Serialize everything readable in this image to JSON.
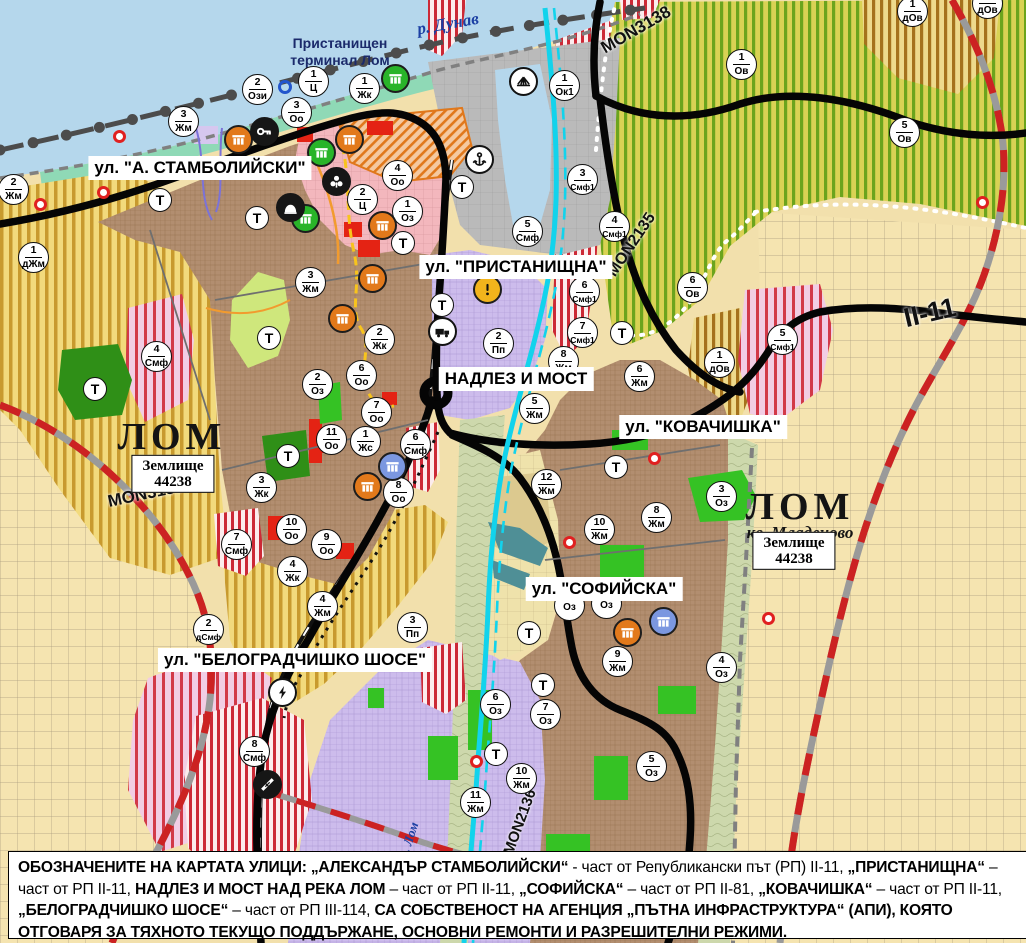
{
  "palette": {
    "water": "#b5d7ec",
    "coast_mint": "#8fd9b6",
    "farmland": "#f2da7c",
    "farmland_stripe": "#c89a2e",
    "vineyard": "#d9d254",
    "vineyard_stripe": "#6ba41d",
    "town_brown": "#b28e70",
    "production_purple": "#cdbcec",
    "mixed_red_stripe": "#cc2936",
    "center_pink": "#f3b7bd",
    "port_gray": "#bababa",
    "floodplain": "#cdd8ac",
    "fields_cream": "#f5e4b0",
    "park_green": "#35c224",
    "road_black": "#050505",
    "project_road_red": "#cc2222",
    "river_cyan": "#12d3ec",
    "marker_orange": "#e2791b",
    "marker_green": "#29b429",
    "marker_blue": "#7b97e0"
  },
  "labels": {
    "streets": [
      {
        "text": "ул. \"А. СТАМБОЛИЙСКИ\"",
        "x": 200,
        "y": 168
      },
      {
        "text": "ул. \"ПРИСТАНИЩНА\"",
        "x": 516,
        "y": 267
      },
      {
        "text": "НАДЛЕЗ И МОСТ",
        "x": 516,
        "y": 379
      },
      {
        "text": "ул. \"КОВАЧИШКА\"",
        "x": 703,
        "y": 427
      },
      {
        "text": "ул. \"СОФИЙСКА\"",
        "x": 604,
        "y": 589
      },
      {
        "text": "ул. \"БЕЛОГРАДЧИШКО ШОСЕ\"",
        "x": 295,
        "y": 660
      }
    ],
    "cities": [
      {
        "name": "ЛОМ",
        "x": 172,
        "y": 437,
        "size": 38,
        "sub": "",
        "subx": 0,
        "suby": 0
      },
      {
        "name": "ЛОМ",
        "x": 800,
        "y": 507,
        "size": 38,
        "sub": "кв. Младеново",
        "subx": 800,
        "suby": 533
      }
    ],
    "landholdings": [
      {
        "line1": "Землище",
        "line2": "44238",
        "x": 173,
        "y": 474
      },
      {
        "line1": "Землище",
        "line2": "44238",
        "x": 794,
        "y": 551
      }
    ],
    "road_codes": [
      {
        "text": "MON3139",
        "x": 146,
        "y": 494,
        "rot": -12,
        "size": 17
      },
      {
        "text": "MON3138",
        "x": 636,
        "y": 30,
        "rot": -30,
        "size": 17
      },
      {
        "text": "MON2135",
        "x": 632,
        "y": 245,
        "rot": -56,
        "size": 16
      },
      {
        "text": "MON2136",
        "x": 520,
        "y": 822,
        "rot": -70,
        "size": 15
      },
      {
        "text": "II-11",
        "x": 930,
        "y": 313,
        "rot": -13,
        "size": 27
      }
    ],
    "rivers": [
      {
        "text": "р. Дунав",
        "x": 448,
        "y": 24,
        "rot": -10,
        "size": 17
      },
      {
        "text": "р. Лом",
        "x": 409,
        "y": 840,
        "rot": -72,
        "size": 13
      }
    ],
    "terminal": {
      "line1": "Пристанищен",
      "line2": "терминал Лом",
      "x": 340,
      "y": 52
    }
  },
  "markers": {
    "transport_letter": "Т",
    "zones": [
      {
        "x": 14,
        "y": 190,
        "n": "2",
        "c": "Жм"
      },
      {
        "x": 34,
        "y": 258,
        "n": "1",
        "c": "дЖм"
      },
      {
        "x": 184,
        "y": 122,
        "n": "3",
        "c": "Жм"
      },
      {
        "x": 258,
        "y": 90,
        "n": "2",
        "c": "Ози"
      },
      {
        "x": 314,
        "y": 82,
        "n": "1",
        "c": "Ц"
      },
      {
        "x": 297,
        "y": 113,
        "n": "3",
        "c": "Оо"
      },
      {
        "x": 365,
        "y": 89,
        "n": "1",
        "c": "Жк"
      },
      {
        "x": 398,
        "y": 176,
        "n": "4",
        "c": "Оо"
      },
      {
        "x": 363,
        "y": 200,
        "n": "2",
        "c": "Ц"
      },
      {
        "x": 408,
        "y": 212,
        "n": "1",
        "c": "Оз"
      },
      {
        "x": 157,
        "y": 357,
        "n": "4",
        "c": "Смф"
      },
      {
        "x": 311,
        "y": 283,
        "n": "3",
        "c": "Жм"
      },
      {
        "x": 380,
        "y": 340,
        "n": "2",
        "c": "Жк"
      },
      {
        "x": 318,
        "y": 385,
        "n": "2",
        "c": "Оз"
      },
      {
        "x": 362,
        "y": 376,
        "n": "6",
        "c": "Оо"
      },
      {
        "x": 377,
        "y": 413,
        "n": "7",
        "c": "Оо"
      },
      {
        "x": 332,
        "y": 440,
        "n": "11",
        "c": "Оо"
      },
      {
        "x": 366,
        "y": 442,
        "n": "1",
        "c": "Жс"
      },
      {
        "x": 416,
        "y": 445,
        "n": "6",
        "c": "Смф"
      },
      {
        "x": 399,
        "y": 493,
        "n": "8",
        "c": "Оо"
      },
      {
        "x": 262,
        "y": 488,
        "n": "3",
        "c": "Жк"
      },
      {
        "x": 292,
        "y": 530,
        "n": "10",
        "c": "Оо"
      },
      {
        "x": 327,
        "y": 545,
        "n": "9",
        "c": "Оо"
      },
      {
        "x": 293,
        "y": 572,
        "n": "4",
        "c": "Жк"
      },
      {
        "x": 237,
        "y": 545,
        "n": "7",
        "c": "Смф"
      },
      {
        "x": 528,
        "y": 232,
        "n": "5",
        "c": "Смф"
      },
      {
        "x": 565,
        "y": 86,
        "n": "1",
        "c": "Ок1"
      },
      {
        "x": 583,
        "y": 180,
        "n": "3",
        "c": "Смф1"
      },
      {
        "x": 615,
        "y": 227,
        "n": "4",
        "c": "Смф1"
      },
      {
        "x": 585,
        "y": 292,
        "n": "6",
        "c": "Смф1"
      },
      {
        "x": 583,
        "y": 333,
        "n": "7",
        "c": "Смф1"
      },
      {
        "x": 499,
        "y": 344,
        "n": "2",
        "c": "Пп"
      },
      {
        "x": 564,
        "y": 362,
        "n": "8",
        "c": "Жм"
      },
      {
        "x": 535,
        "y": 409,
        "n": "5",
        "c": "Жм"
      },
      {
        "x": 742,
        "y": 65,
        "n": "1",
        "c": "Ов"
      },
      {
        "x": 913,
        "y": 12,
        "n": "1",
        "c": "дОв"
      },
      {
        "x": 988,
        "y": 4,
        "n": "1",
        "c": "дОв"
      },
      {
        "x": 905,
        "y": 133,
        "n": "5",
        "c": "Ов"
      },
      {
        "x": 693,
        "y": 288,
        "n": "6",
        "c": "Ов"
      },
      {
        "x": 783,
        "y": 340,
        "n": "5",
        "c": "Смф1"
      },
      {
        "x": 720,
        "y": 363,
        "n": "1",
        "c": "дОв"
      },
      {
        "x": 640,
        "y": 377,
        "n": "6",
        "c": "Жм"
      },
      {
        "x": 657,
        "y": 518,
        "n": "8",
        "c": "Жм"
      },
      {
        "x": 547,
        "y": 485,
        "n": "12",
        "c": "Жм"
      },
      {
        "x": 600,
        "y": 530,
        "n": "10",
        "c": "Жм"
      },
      {
        "x": 618,
        "y": 662,
        "n": "9",
        "c": "Жм"
      },
      {
        "x": 722,
        "y": 497,
        "n": "3",
        "c": "Оз"
      },
      {
        "x": 570,
        "y": 606,
        "n": "",
        "c": "Оз"
      },
      {
        "x": 607,
        "y": 604,
        "n": "",
        "c": "Оз"
      },
      {
        "x": 722,
        "y": 668,
        "n": "4",
        "c": "Оз"
      },
      {
        "x": 652,
        "y": 767,
        "n": "5",
        "c": "Оз"
      },
      {
        "x": 496,
        "y": 705,
        "n": "6",
        "c": "Оз"
      },
      {
        "x": 546,
        "y": 715,
        "n": "7",
        "c": "Оз"
      },
      {
        "x": 522,
        "y": 779,
        "n": "10",
        "c": "Жм"
      },
      {
        "x": 476,
        "y": 803,
        "n": "11",
        "c": "Жм"
      },
      {
        "x": 209,
        "y": 630,
        "n": "2",
        "c": "дСмф"
      },
      {
        "x": 323,
        "y": 607,
        "n": "4",
        "c": "Жм"
      },
      {
        "x": 413,
        "y": 628,
        "n": "3",
        "c": "Пп"
      },
      {
        "x": 255,
        "y": 752,
        "n": "8",
        "c": "Смф"
      }
    ],
    "transport": [
      {
        "x": 160,
        "y": 200
      },
      {
        "x": 257,
        "y": 218
      },
      {
        "x": 269,
        "y": 338
      },
      {
        "x": 288,
        "y": 456
      },
      {
        "x": 95,
        "y": 389
      },
      {
        "x": 462,
        "y": 187
      },
      {
        "x": 403,
        "y": 243
      },
      {
        "x": 442,
        "y": 305
      },
      {
        "x": 622,
        "y": 333
      },
      {
        "x": 616,
        "y": 467
      },
      {
        "x": 529,
        "y": 633
      },
      {
        "x": 543,
        "y": 685
      },
      {
        "x": 496,
        "y": 754
      }
    ],
    "icons": [
      {
        "x": 239,
        "y": 140,
        "type": "monument",
        "color": "orange"
      },
      {
        "x": 350,
        "y": 140,
        "type": "monument",
        "color": "orange"
      },
      {
        "x": 383,
        "y": 226,
        "type": "monument",
        "color": "orange"
      },
      {
        "x": 373,
        "y": 279,
        "type": "monument",
        "color": "orange"
      },
      {
        "x": 343,
        "y": 319,
        "type": "monument",
        "color": "orange"
      },
      {
        "x": 368,
        "y": 487,
        "type": "monument",
        "color": "orange"
      },
      {
        "x": 628,
        "y": 633,
        "type": "monument",
        "color": "orange"
      },
      {
        "x": 396,
        "y": 79,
        "type": "monument",
        "color": "green"
      },
      {
        "x": 322,
        "y": 153,
        "type": "monument",
        "color": "green"
      },
      {
        "x": 306,
        "y": 219,
        "type": "monument",
        "color": "green"
      },
      {
        "x": 393,
        "y": 467,
        "type": "monument",
        "color": "blue"
      },
      {
        "x": 664,
        "y": 622,
        "type": "monument",
        "color": "blue"
      },
      {
        "x": 265,
        "y": 132,
        "type": "key",
        "color": "black"
      },
      {
        "x": 337,
        "y": 182,
        "type": "trefoil",
        "color": "black"
      },
      {
        "x": 291,
        "y": 208,
        "type": "dome",
        "color": "black"
      },
      {
        "x": 480,
        "y": 160,
        "type": "anchor",
        "color": "white"
      },
      {
        "x": 524,
        "y": 82,
        "type": "crane",
        "color": "white"
      },
      {
        "x": 443,
        "y": 332,
        "type": "truck",
        "color": "white"
      },
      {
        "x": 488,
        "y": 290,
        "type": "warning",
        "color": "yellow"
      },
      {
        "x": 283,
        "y": 693,
        "type": "lightning",
        "color": "white"
      },
      {
        "x": 268,
        "y": 785,
        "type": "crossing",
        "color": "black"
      }
    ],
    "red_dots": [
      {
        "x": 120,
        "y": 137
      },
      {
        "x": 104,
        "y": 193
      },
      {
        "x": 41,
        "y": 205
      },
      {
        "x": 655,
        "y": 459
      },
      {
        "x": 570,
        "y": 543
      },
      {
        "x": 477,
        "y": 762
      },
      {
        "x": 769,
        "y": 619
      },
      {
        "x": 983,
        "y": 203
      }
    ],
    "blue_rings": [
      {
        "x": 285,
        "y": 87
      }
    ]
  },
  "footer": {
    "segments": [
      {
        "b": true,
        "t": "ОБОЗНАЧЕНИТЕ НА КАРТАТА УЛИЦИ: „АЛЕКСАНДЪР СТАМБОЛИЙСКИ“"
      },
      {
        "b": false,
        "t": " - част от Републикански път (РП) II-11, "
      },
      {
        "b": true,
        "t": "„ПРИСТАНИЩНА“"
      },
      {
        "b": false,
        "t": " – част от РП II-11, "
      },
      {
        "b": true,
        "t": "НАДЛЕЗ И МОСТ НАД РЕКА ЛОМ"
      },
      {
        "b": false,
        "t": " – част от РП II-11, "
      },
      {
        "b": true,
        "t": "„СОФИЙСКА“"
      },
      {
        "b": false,
        "t": " – част от РП II-81, "
      },
      {
        "b": true,
        "t": "„КОВАЧИШКА“"
      },
      {
        "b": false,
        "t": " – част от РП II-11, "
      },
      {
        "b": true,
        "t": "„БЕЛОГРАДЧИШКО ШОСЕ“"
      },
      {
        "b": false,
        "t": " – част от РП III-114, "
      },
      {
        "b": true,
        "t": "СА СОБСТВЕНОСТ НА АГЕНЦИЯ „ПЪТНА ИНФРАСТРУКТУРА“ (АПИ), КОЯТО ОТГОВАРЯ ЗА ТЯХНОТО ТЕКУЩО ПОДДЪРЖАНЕ, ОСНОВНИ РЕМОНТИ И РАЗРЕШИТЕЛНИ РЕЖИМИ."
      }
    ]
  }
}
